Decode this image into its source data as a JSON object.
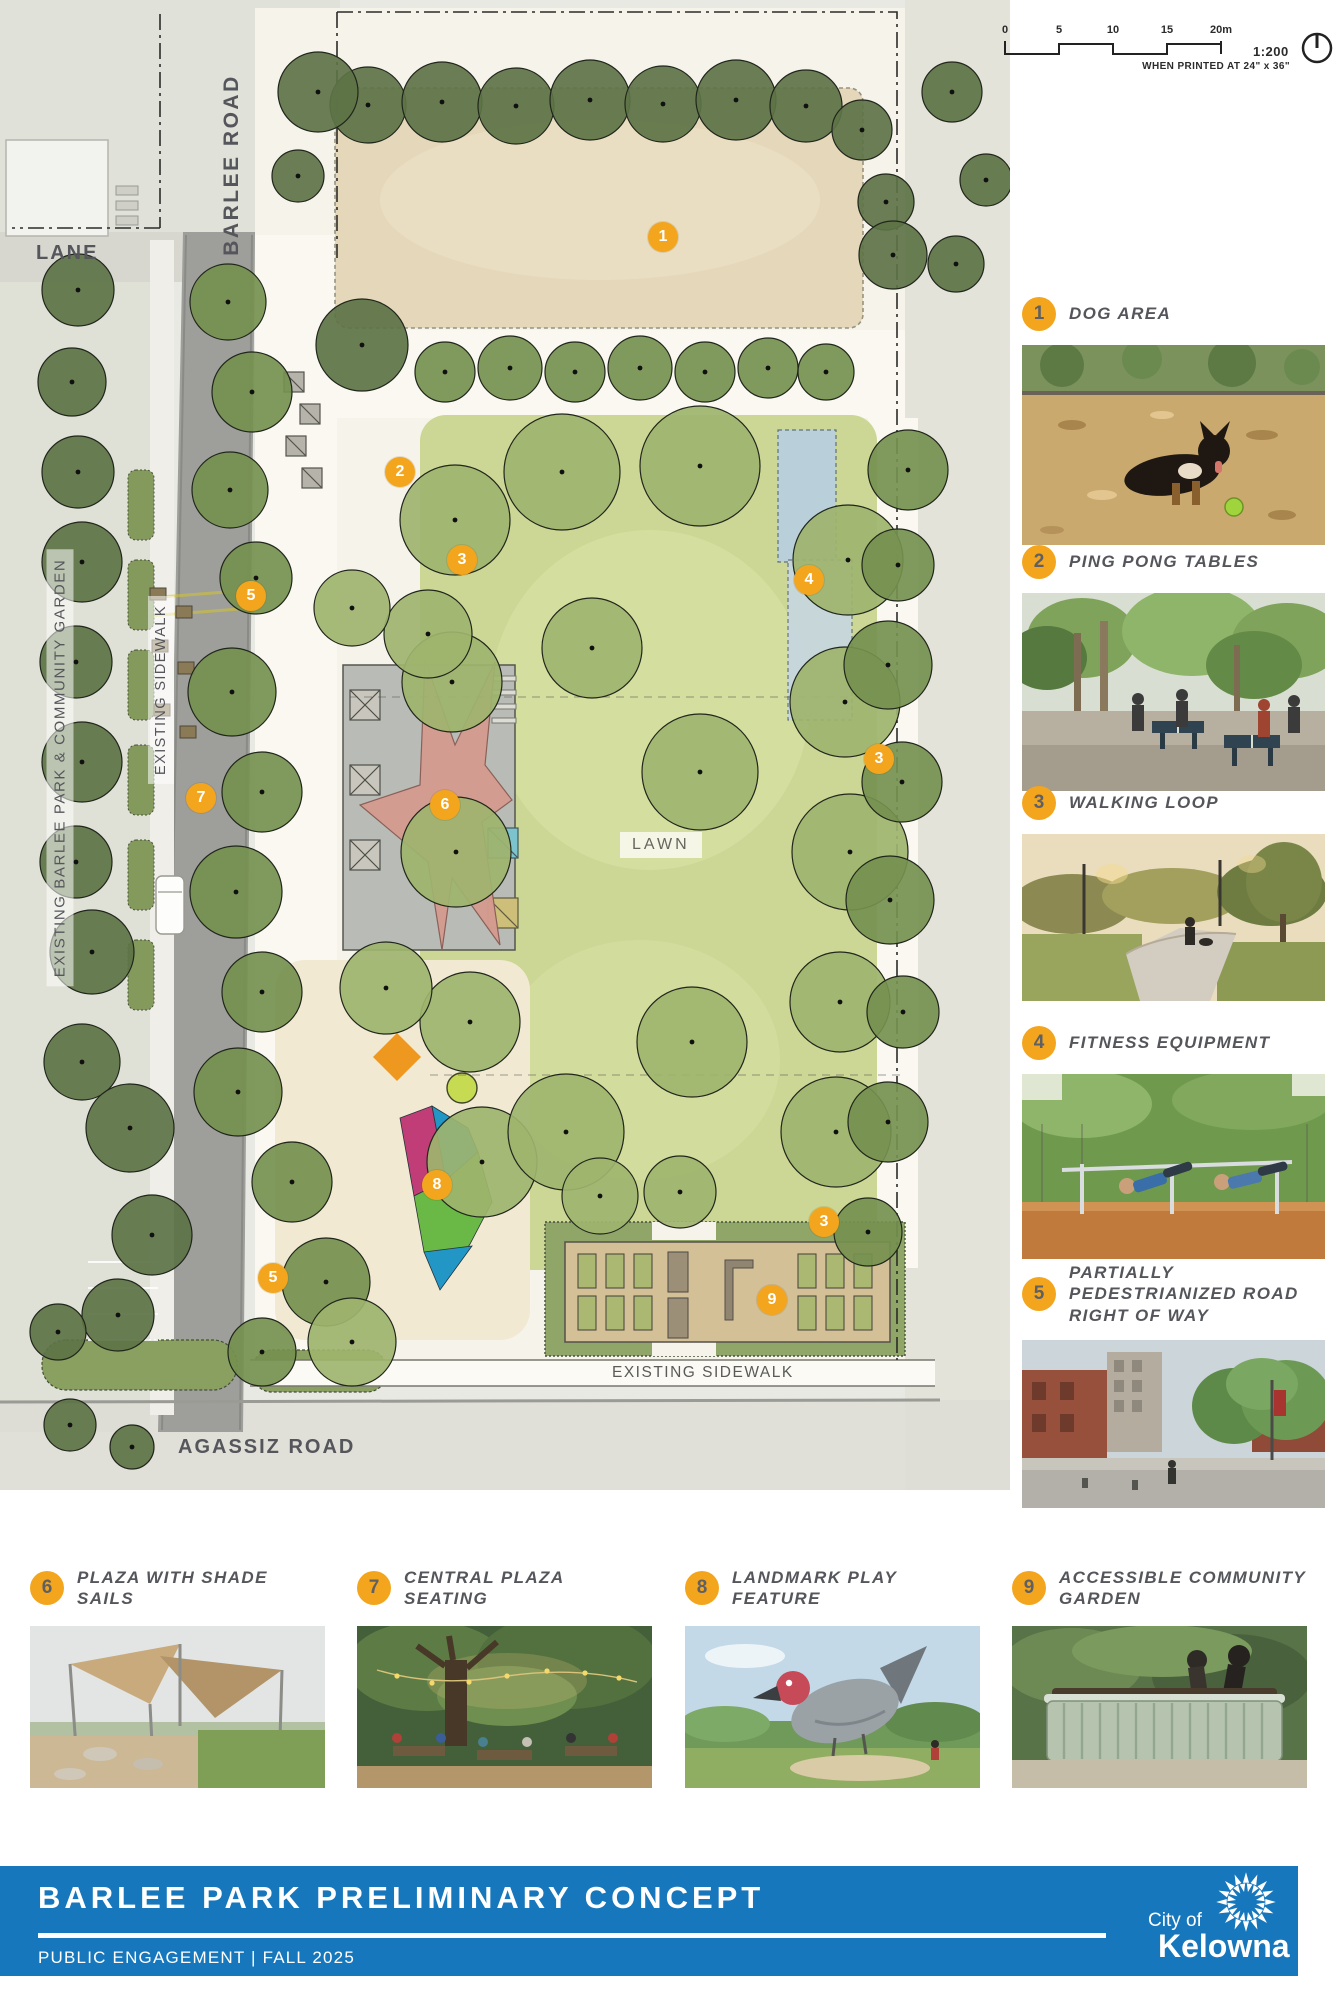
{
  "scalebar": {
    "ticks": [
      "0",
      "5",
      "10",
      "15",
      "20m"
    ],
    "ratio": "1:200",
    "note": "WHEN PRINTED AT 24\" x 36\""
  },
  "plan": {
    "labels": {
      "barlee_road": "BARLEE ROAD",
      "lane": "LANE",
      "existing_park": "EXISTING BARLEE PARK & COMMUNITY GARDEN",
      "existing_sidewalk_west": "EXISTING SIDEWALK",
      "lawn": "LAWN",
      "existing_sidewalk_south": "EXISTING SIDEWALK",
      "agassiz_road": "AGASSIZ ROAD"
    },
    "markers": [
      {
        "num": "1",
        "x": 663,
        "y": 237
      },
      {
        "num": "2",
        "x": 400,
        "y": 472
      },
      {
        "num": "3",
        "x": 462,
        "y": 560
      },
      {
        "num": "4",
        "x": 809,
        "y": 580
      },
      {
        "num": "5",
        "x": 251,
        "y": 596
      },
      {
        "num": "7",
        "x": 201,
        "y": 798
      },
      {
        "num": "6",
        "x": 445,
        "y": 805
      },
      {
        "num": "3",
        "x": 879,
        "y": 759
      },
      {
        "num": "8",
        "x": 437,
        "y": 1185
      },
      {
        "num": "5",
        "x": 273,
        "y": 1278
      },
      {
        "num": "3",
        "x": 824,
        "y": 1222
      },
      {
        "num": "9",
        "x": 772,
        "y": 1300
      }
    ]
  },
  "legend_side": [
    {
      "num": "1",
      "label": "DOG AREA"
    },
    {
      "num": "2",
      "label": "PING PONG TABLES"
    },
    {
      "num": "3",
      "label": "WALKING LOOP"
    },
    {
      "num": "4",
      "label": "FITNESS EQUIPMENT"
    },
    {
      "num": "5",
      "label": "PARTIALLY PEDESTRIANIZED ROAD RIGHT OF WAY"
    }
  ],
  "legend_bottom": [
    {
      "num": "6",
      "label": "PLAZA WITH SHADE SAILS"
    },
    {
      "num": "7",
      "label": "CENTRAL PLAZA SEATING"
    },
    {
      "num": "8",
      "label": "LANDMARK PLAY FEATURE"
    },
    {
      "num": "9",
      "label": "ACCESSIBLE COMMUNITY GARDEN"
    }
  ],
  "footer": {
    "title": "BARLEE PARK PRELIMINARY CONCEPT",
    "subtitle": "PUBLIC ENGAGEMENT | FALL 2025",
    "logo_city": "City of",
    "logo_name": "Kelowna"
  },
  "colors": {
    "accent_orange": "#F3A51D",
    "banner_blue": "#1677BC",
    "label_gray": "#55565B"
  }
}
